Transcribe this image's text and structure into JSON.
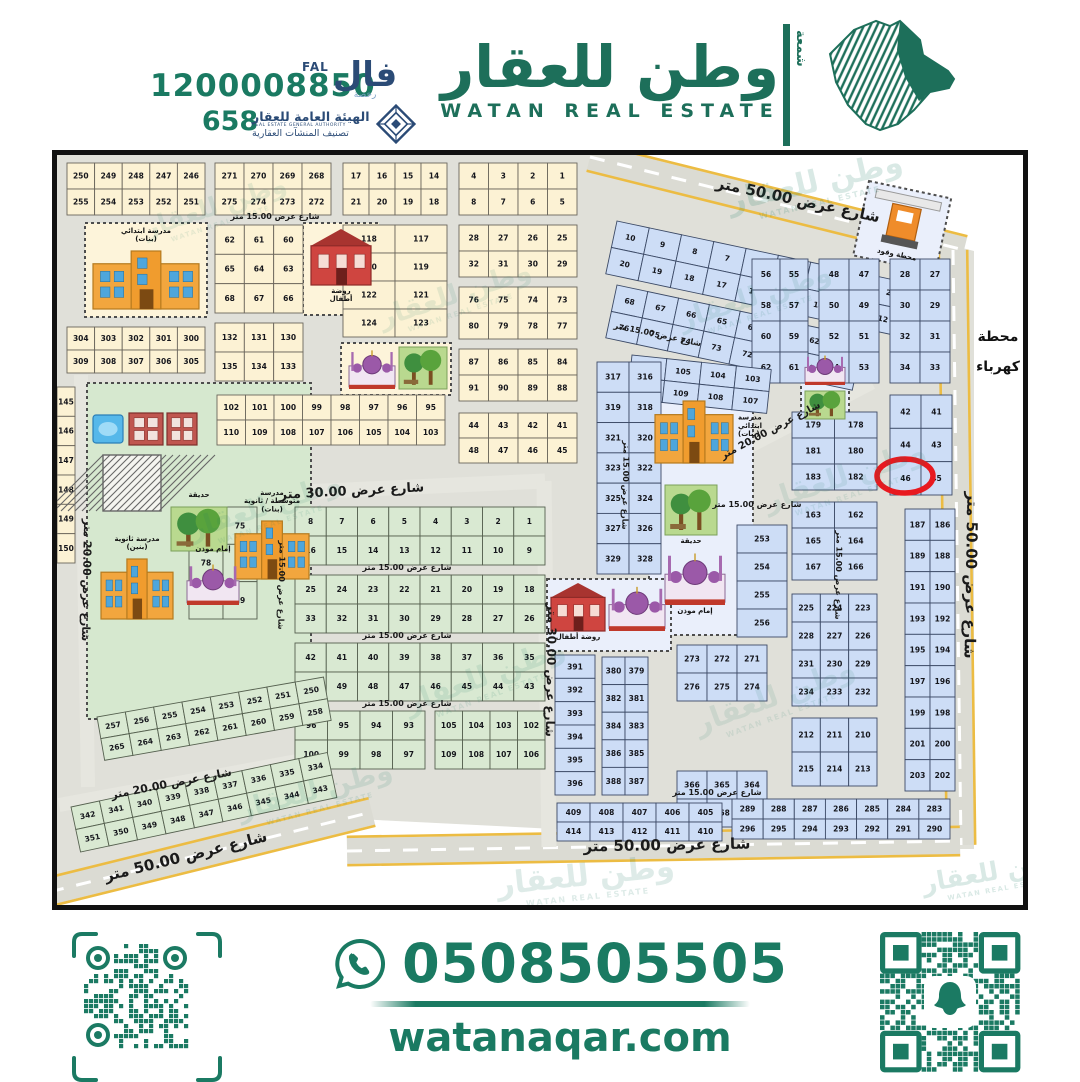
{
  "colors": {
    "brand": "#1a7a62",
    "brand_dark": "#1d6f5a",
    "navy": "#2b4b76",
    "ground": "#e0e0d9",
    "road_major": "#dbdbd3",
    "road_medium": "#e6e6df",
    "road_edge": "#ecbc43",
    "cream": "#fcf2d4",
    "cream_stroke": "#6b665c",
    "mint": "#d9e9d2",
    "mint_stroke": "#55604f",
    "blue": "#cdddf6",
    "blue_stroke": "#3c4a66",
    "srvG": "#d6e8cf",
    "srvB": "#eaeffb",
    "srvC": "#fdf4da",
    "highlight_red": "#e8191f"
  },
  "header": {
    "phone_main": "1200008850",
    "license": "658",
    "fal_en": "FAL",
    "fal_ar": "فال",
    "fal_sub": "رخصة",
    "authority_ar": "الهيئة العامة للعقار",
    "authority_en": "REAL ESTATE GENERAL AUTHORITY",
    "authority_sub": "تصنيف المنشآت العقارية",
    "brand_ar": "وطن للعقار",
    "brand_en": "WATAN REAL ESTATE",
    "brand_side": "شمعة"
  },
  "footer": {
    "whatsapp_phone": "0508505505",
    "website": "watanaqar.com"
  },
  "map": {
    "watermark": {
      "ar": "وطن للعقار",
      "en": "WATAN REAL ESTATE"
    },
    "edge_station": [
      "محطة",
      "كهرباء"
    ],
    "highlight": {
      "plot": "46",
      "cx": 848,
      "cy": 321,
      "rx": 28,
      "ry": 17
    },
    "roads": [
      {
        "x1": 533,
        "y1": 2,
        "x2": 907,
        "y2": 95,
        "w": 26,
        "major": true
      },
      {
        "x1": 896,
        "y1": 95,
        "x2": 904,
        "y2": 690,
        "w": 26,
        "major": true
      },
      {
        "x1": 290,
        "y1": 696,
        "x2": 903,
        "y2": 686,
        "w": 26,
        "major": true
      },
      {
        "x1": -8,
        "y1": 737,
        "x2": 315,
        "y2": 657,
        "w": 26,
        "major": true
      },
      {
        "x1": 0,
        "y1": 348,
        "x2": 488,
        "y2": 326,
        "w": 15
      },
      {
        "x1": 487,
        "y1": 326,
        "x2": 492,
        "y2": 692,
        "w": 15
      },
      {
        "x1": 24,
        "y1": 220,
        "x2": 31,
        "y2": 632,
        "w": 14
      },
      {
        "x1": 2,
        "y1": 650,
        "x2": 305,
        "y2": 594,
        "w": 14
      },
      {
        "x1": 600,
        "y1": 340,
        "x2": 815,
        "y2": 228,
        "w": 13
      }
    ],
    "street_labels": [
      {
        "t": "شارع عرض 50.00 متر",
        "x": 740,
        "y": 50,
        "r": 12,
        "s": 15
      },
      {
        "t": "شارع عرض 50.00 متر",
        "x": 909,
        "y": 420,
        "r": 91,
        "s": 15
      },
      {
        "t": "شارع عرض 50.00 متر",
        "x": 610,
        "y": 695,
        "r": -1,
        "s": 15
      },
      {
        "t": "شارع عرض 50.00 متر",
        "x": 130,
        "y": 706,
        "r": -14,
        "s": 15
      },
      {
        "t": "شارع عرض 30.00 متر",
        "x": 295,
        "y": 340,
        "r": -3,
        "s": 13
      },
      {
        "t": "شارع عرض 30.00 متر",
        "x": 490,
        "y": 515,
        "r": 91,
        "s": 12
      },
      {
        "t": "شارع عرض 20.00 متر",
        "x": 26,
        "y": 425,
        "r": 91,
        "s": 11
      },
      {
        "t": "شارع عرض 20.00 متر",
        "x": 115,
        "y": 632,
        "r": -11,
        "s": 11
      },
      {
        "t": "شارع عرض 20.00 متر",
        "x": 715,
        "y": 278,
        "r": -28,
        "s": 10
      },
      {
        "t": "شارع عرض 15.00 متر",
        "x": 218,
        "y": 64,
        "r": 0,
        "s": 8
      },
      {
        "t": "شارع عرض 15.00 متر",
        "x": 350,
        "y": 415,
        "r": 0,
        "s": 8
      },
      {
        "t": "شارع عرض 15.00 متر",
        "x": 350,
        "y": 483,
        "r": 0,
        "s": 8
      },
      {
        "t": "شارع عرض 15.00 متر",
        "x": 222,
        "y": 430,
        "r": 91,
        "s": 8
      },
      {
        "t": "شارع عرض 15.00 متر",
        "x": 566,
        "y": 330,
        "r": 91,
        "s": 8
      },
      {
        "t": "شارع عرض 15.00 متر",
        "x": 700,
        "y": 352,
        "r": 0,
        "s": 8
      },
      {
        "t": "شارع عرض 15.00 متر",
        "x": 779,
        "y": 420,
        "r": 91,
        "s": 8
      },
      {
        "t": "شارع عرض 15.00 متر",
        "x": 600,
        "y": 182,
        "r": 12,
        "s": 8
      },
      {
        "t": "شارع عرض 15.00 متر",
        "x": 660,
        "y": 640,
        "r": 0,
        "s": 8
      },
      {
        "t": "شارع عرض 15.00 متر",
        "x": 350,
        "y": 551,
        "r": 0,
        "s": 8
      }
    ],
    "zones": [
      {
        "x": 30,
        "y": 228,
        "w": 224,
        "h": 336,
        "f": "srvG"
      },
      {
        "x": 28,
        "y": 68,
        "w": 122,
        "h": 94,
        "f": "srvC"
      },
      {
        "x": 246,
        "y": 68,
        "w": 76,
        "h": 92,
        "f": "srvC"
      },
      {
        "x": 284,
        "y": 188,
        "w": 110,
        "h": 52,
        "f": "srvC"
      },
      {
        "x": 592,
        "y": 240,
        "w": 104,
        "h": 240,
        "f": "srvB"
      },
      {
        "x": 490,
        "y": 424,
        "w": 124,
        "h": 72,
        "f": "srvB"
      },
      {
        "x": 744,
        "y": 194,
        "w": 48,
        "h": 74,
        "f": "srvB"
      },
      {
        "x": 812,
        "y": 26,
        "w": 84,
        "h": 76,
        "f": "srvB",
        "r": 12
      }
    ],
    "blocks": [
      {
        "x": 10,
        "y": 8,
        "w": 138,
        "h": 52,
        "rows": 2,
        "cols": 5,
        "start": 246,
        "f": "cream"
      },
      {
        "x": 158,
        "y": 8,
        "w": 116,
        "h": 52,
        "rows": 2,
        "cols": 4,
        "start": 268,
        "f": "cream"
      },
      {
        "x": 286,
        "y": 8,
        "w": 104,
        "h": 52,
        "rows": 2,
        "cols": 4,
        "start": 14,
        "f": "cream"
      },
      {
        "x": 402,
        "y": 8,
        "w": 118,
        "h": 52,
        "rows": 2,
        "cols": 4,
        "start": 1,
        "f": "cream"
      },
      {
        "x": 158,
        "y": 70,
        "w": 88,
        "h": 88,
        "rows": 3,
        "cols": 3,
        "start": 60,
        "f": "cream"
      },
      {
        "x": 402,
        "y": 70,
        "w": 118,
        "h": 52,
        "rows": 2,
        "cols": 4,
        "start": 25,
        "f": "cream"
      },
      {
        "x": 402,
        "y": 132,
        "w": 118,
        "h": 52,
        "rows": 2,
        "cols": 4,
        "start": 73,
        "f": "cream"
      },
      {
        "x": 286,
        "y": 70,
        "w": 104,
        "h": 112,
        "rows": 4,
        "cols": 2,
        "start": 117,
        "f": "cream"
      },
      {
        "x": 402,
        "y": 194,
        "w": 118,
        "h": 52,
        "rows": 2,
        "cols": 4,
        "start": 84,
        "f": "cream"
      },
      {
        "x": 158,
        "y": 168,
        "w": 88,
        "h": 58,
        "rows": 2,
        "cols": 3,
        "start": 130,
        "f": "cream"
      },
      {
        "x": 10,
        "y": 172,
        "w": 138,
        "h": 46,
        "rows": 2,
        "cols": 5,
        "start": 300,
        "f": "cream"
      },
      {
        "x": 160,
        "y": 240,
        "w": 228,
        "h": 50,
        "rows": 2,
        "cols": 8,
        "start": 95,
        "f": "cream"
      },
      {
        "x": 402,
        "y": 258,
        "w": 118,
        "h": 50,
        "rows": 2,
        "cols": 4,
        "start": 41,
        "f": "cream"
      },
      {
        "x": 0,
        "y": 232,
        "w": 18,
        "h": 176,
        "rows": 6,
        "cols": 1,
        "start": 145,
        "f": "cream"
      },
      {
        "x": 238,
        "y": 352,
        "w": 250,
        "h": 58,
        "rows": 2,
        "cols": 8,
        "start": 1,
        "f": "mint"
      },
      {
        "x": 238,
        "y": 420,
        "w": 250,
        "h": 58,
        "rows": 2,
        "cols": 8,
        "start": 18,
        "f": "mint"
      },
      {
        "x": 132,
        "y": 352,
        "w": 68,
        "h": 112,
        "rows": 3,
        "cols": 2,
        "start": 75,
        "f": "mint"
      },
      {
        "x": 238,
        "y": 488,
        "w": 250,
        "h": 58,
        "rows": 2,
        "cols": 8,
        "start": 35,
        "f": "mint"
      },
      {
        "x": 238,
        "y": 556,
        "w": 130,
        "h": 58,
        "rows": 2,
        "cols": 4,
        "start": 93,
        "f": "mint"
      },
      {
        "x": 378,
        "y": 556,
        "w": 110,
        "h": 58,
        "rows": 2,
        "cols": 4,
        "start": 102,
        "f": "mint"
      },
      {
        "x": 40,
        "y": 562,
        "w": 230,
        "h": 44,
        "rows": 2,
        "cols": 8,
        "start": 250,
        "f": "mint",
        "r": -10
      },
      {
        "x": 14,
        "y": 652,
        "w": 262,
        "h": 46,
        "rows": 2,
        "cols": 9,
        "start": 334,
        "f": "mint",
        "r": -12
      },
      {
        "x": 560,
        "y": 66,
        "w": 330,
        "h": 54,
        "rows": 2,
        "cols": 10,
        "start": 1,
        "f": "blue",
        "r": 12
      },
      {
        "x": 560,
        "y": 130,
        "w": 252,
        "h": 54,
        "rows": 2,
        "cols": 8,
        "start": 61,
        "f": "blue",
        "r": 12
      },
      {
        "x": 833,
        "y": 104,
        "w": 60,
        "h": 124,
        "rows": 4,
        "cols": 2,
        "start": 27,
        "f": "blue"
      },
      {
        "x": 833,
        "y": 240,
        "w": 62,
        "h": 100,
        "f": "blue",
        "nums": [
          [
            42,
            41
          ],
          [
            44,
            43
          ],
          [
            46,
            45
          ]
        ]
      },
      {
        "x": 762,
        "y": 104,
        "w": 60,
        "h": 124,
        "rows": 4,
        "cols": 2,
        "start": 47,
        "f": "blue"
      },
      {
        "x": 695,
        "y": 104,
        "w": 56,
        "h": 124,
        "rows": 4,
        "cols": 2,
        "start": 55,
        "f": "blue"
      },
      {
        "x": 575,
        "y": 200,
        "w": 140,
        "h": 44,
        "rows": 2,
        "cols": 4,
        "start": 103,
        "f": "blue",
        "r": 6
      },
      {
        "x": 540,
        "y": 207,
        "w": 64,
        "h": 212,
        "rows": 7,
        "cols": 2,
        "start": 316,
        "f": "blue"
      },
      {
        "x": 735,
        "y": 257,
        "w": 85,
        "h": 78,
        "rows": 3,
        "cols": 2,
        "start": 178,
        "f": "blue"
      },
      {
        "x": 735,
        "y": 347,
        "w": 85,
        "h": 78,
        "rows": 3,
        "cols": 2,
        "start": 162,
        "f": "blue"
      },
      {
        "x": 848,
        "y": 354,
        "w": 50,
        "h": 282,
        "rows": 9,
        "cols": 2,
        "start": 186,
        "f": "blue"
      },
      {
        "x": 680,
        "y": 370,
        "w": 50,
        "h": 112,
        "rows": 4,
        "cols": 1,
        "start": 253,
        "f": "blue"
      },
      {
        "x": 735,
        "y": 439,
        "w": 85,
        "h": 112,
        "rows": 4,
        "cols": 3,
        "start": 223,
        "f": "blue"
      },
      {
        "x": 735,
        "y": 563,
        "w": 85,
        "h": 68,
        "rows": 2,
        "cols": 3,
        "start": 210,
        "f": "blue"
      },
      {
        "x": 620,
        "y": 490,
        "w": 90,
        "h": 56,
        "rows": 2,
        "cols": 3,
        "start": 271,
        "f": "blue"
      },
      {
        "x": 498,
        "y": 500,
        "w": 40,
        "h": 140,
        "rows": 6,
        "cols": 1,
        "start": 391,
        "f": "blue"
      },
      {
        "x": 545,
        "y": 502,
        "w": 46,
        "h": 138,
        "rows": 5,
        "cols": 2,
        "start": 379,
        "f": "blue"
      },
      {
        "x": 620,
        "y": 616,
        "w": 90,
        "h": 56,
        "rows": 2,
        "cols": 3,
        "start": 364,
        "f": "blue"
      },
      {
        "x": 500,
        "y": 648,
        "w": 165,
        "h": 38,
        "rows": 2,
        "cols": 5,
        "start": 405,
        "f": "blue"
      },
      {
        "x": 675,
        "y": 644,
        "w": 218,
        "h": 40,
        "rows": 2,
        "cols": 7,
        "start": 283,
        "f": "blue"
      }
    ],
    "landmarks": [
      {
        "type": "school",
        "x": 36,
        "y": 96,
        "w": 106,
        "h": 58,
        "label": "مدرسة ابتدائي|(بنات)",
        "lp": "top"
      },
      {
        "type": "kg",
        "x": 254,
        "y": 74,
        "w": 60,
        "h": 56,
        "label": "روضة|أطفال",
        "lp": "bottom"
      },
      {
        "type": "mosque",
        "x": 292,
        "y": 192,
        "w": 46,
        "h": 42
      },
      {
        "type": "park",
        "x": 342,
        "y": 192,
        "w": 48,
        "h": 42
      },
      {
        "type": "water",
        "x": 36,
        "y": 260,
        "w": 30,
        "h": 28
      },
      {
        "type": "clinic",
        "x": 72,
        "y": 258,
        "w": 34,
        "h": 32
      },
      {
        "type": "clinic",
        "x": 110,
        "y": 258,
        "w": 30,
        "h": 32
      },
      {
        "type": "hatch",
        "x": 46,
        "y": 300,
        "w": 58,
        "h": 56
      },
      {
        "type": "park",
        "x": 114,
        "y": 352,
        "w": 56,
        "h": 44,
        "label": "حديقة",
        "lp": "top"
      },
      {
        "type": "school",
        "x": 178,
        "y": 366,
        "w": 74,
        "h": 58,
        "label": "مدرسة|متوسطة / ثانوية|(بنات)",
        "lp": "top"
      },
      {
        "type": "school",
        "x": 44,
        "y": 404,
        "w": 72,
        "h": 60,
        "label": "مدرسة ثانوية|(بنين)",
        "lp": "top"
      },
      {
        "type": "mosque",
        "x": 130,
        "y": 406,
        "w": 52,
        "h": 44,
        "label": "إمام موذن",
        "lp": "top"
      },
      {
        "type": "school",
        "x": 598,
        "y": 246,
        "w": 78,
        "h": 62,
        "label": "مدرسة|ابتدائي|(بنات)",
        "lp": "right"
      },
      {
        "type": "park",
        "x": 608,
        "y": 330,
        "w": 52,
        "h": 50,
        "label": "حديقة",
        "lp": "bottom"
      },
      {
        "type": "mosque",
        "x": 608,
        "y": 394,
        "w": 60,
        "h": 56,
        "label": "إمام موذن",
        "lp": "bottom"
      },
      {
        "type": "kg",
        "x": 494,
        "y": 428,
        "w": 54,
        "h": 48,
        "label": "روضة أطفال",
        "lp": "bottom"
      },
      {
        "type": "mosque",
        "x": 552,
        "y": 428,
        "w": 56,
        "h": 48
      },
      {
        "type": "mosque",
        "x": 748,
        "y": 198,
        "w": 40,
        "h": 32
      },
      {
        "type": "park",
        "x": 748,
        "y": 236,
        "w": 40,
        "h": 28
      },
      {
        "type": "gas",
        "x": 820,
        "y": 34,
        "w": 66,
        "h": 54,
        "r": 12,
        "label": "محطة وقود",
        "lp": "bottom"
      }
    ],
    "watermarks": [
      {
        "x": 60,
        "y": 30,
        "r": -18,
        "s": 0.75,
        "a": 0.1
      },
      {
        "x": 300,
        "y": 118,
        "r": -18,
        "s": 0.8,
        "a": 0.1
      },
      {
        "x": 110,
        "y": 330,
        "r": -18,
        "s": 0.8,
        "a": 0.1
      },
      {
        "x": 330,
        "y": 500,
        "r": -20,
        "s": 0.85,
        "a": 0.11
      },
      {
        "x": 600,
        "y": 120,
        "r": -18,
        "s": 0.8,
        "a": 0.11
      },
      {
        "x": 690,
        "y": 300,
        "r": -18,
        "s": 0.85,
        "a": 0.1
      },
      {
        "x": 620,
        "y": 520,
        "r": -20,
        "s": 0.85,
        "a": 0.1
      },
      {
        "x": 160,
        "y": 614,
        "r": -15,
        "s": 0.8,
        "a": 0.12
      },
      {
        "x": 660,
        "y": 6,
        "r": -13,
        "s": 0.9,
        "a": 0.16
      },
      {
        "x": 915,
        "y": 230,
        "r": -90,
        "s": 0.7,
        "a": 0.24
      },
      {
        "x": 915,
        "y": 540,
        "r": -90,
        "s": 0.7,
        "a": 0.24
      },
      {
        "x": 430,
        "y": 700,
        "r": -6,
        "s": 0.9,
        "a": 0.14
      },
      {
        "x": 840,
        "y": 695,
        "r": -10,
        "s": 0.75,
        "a": 0.16
      }
    ]
  }
}
